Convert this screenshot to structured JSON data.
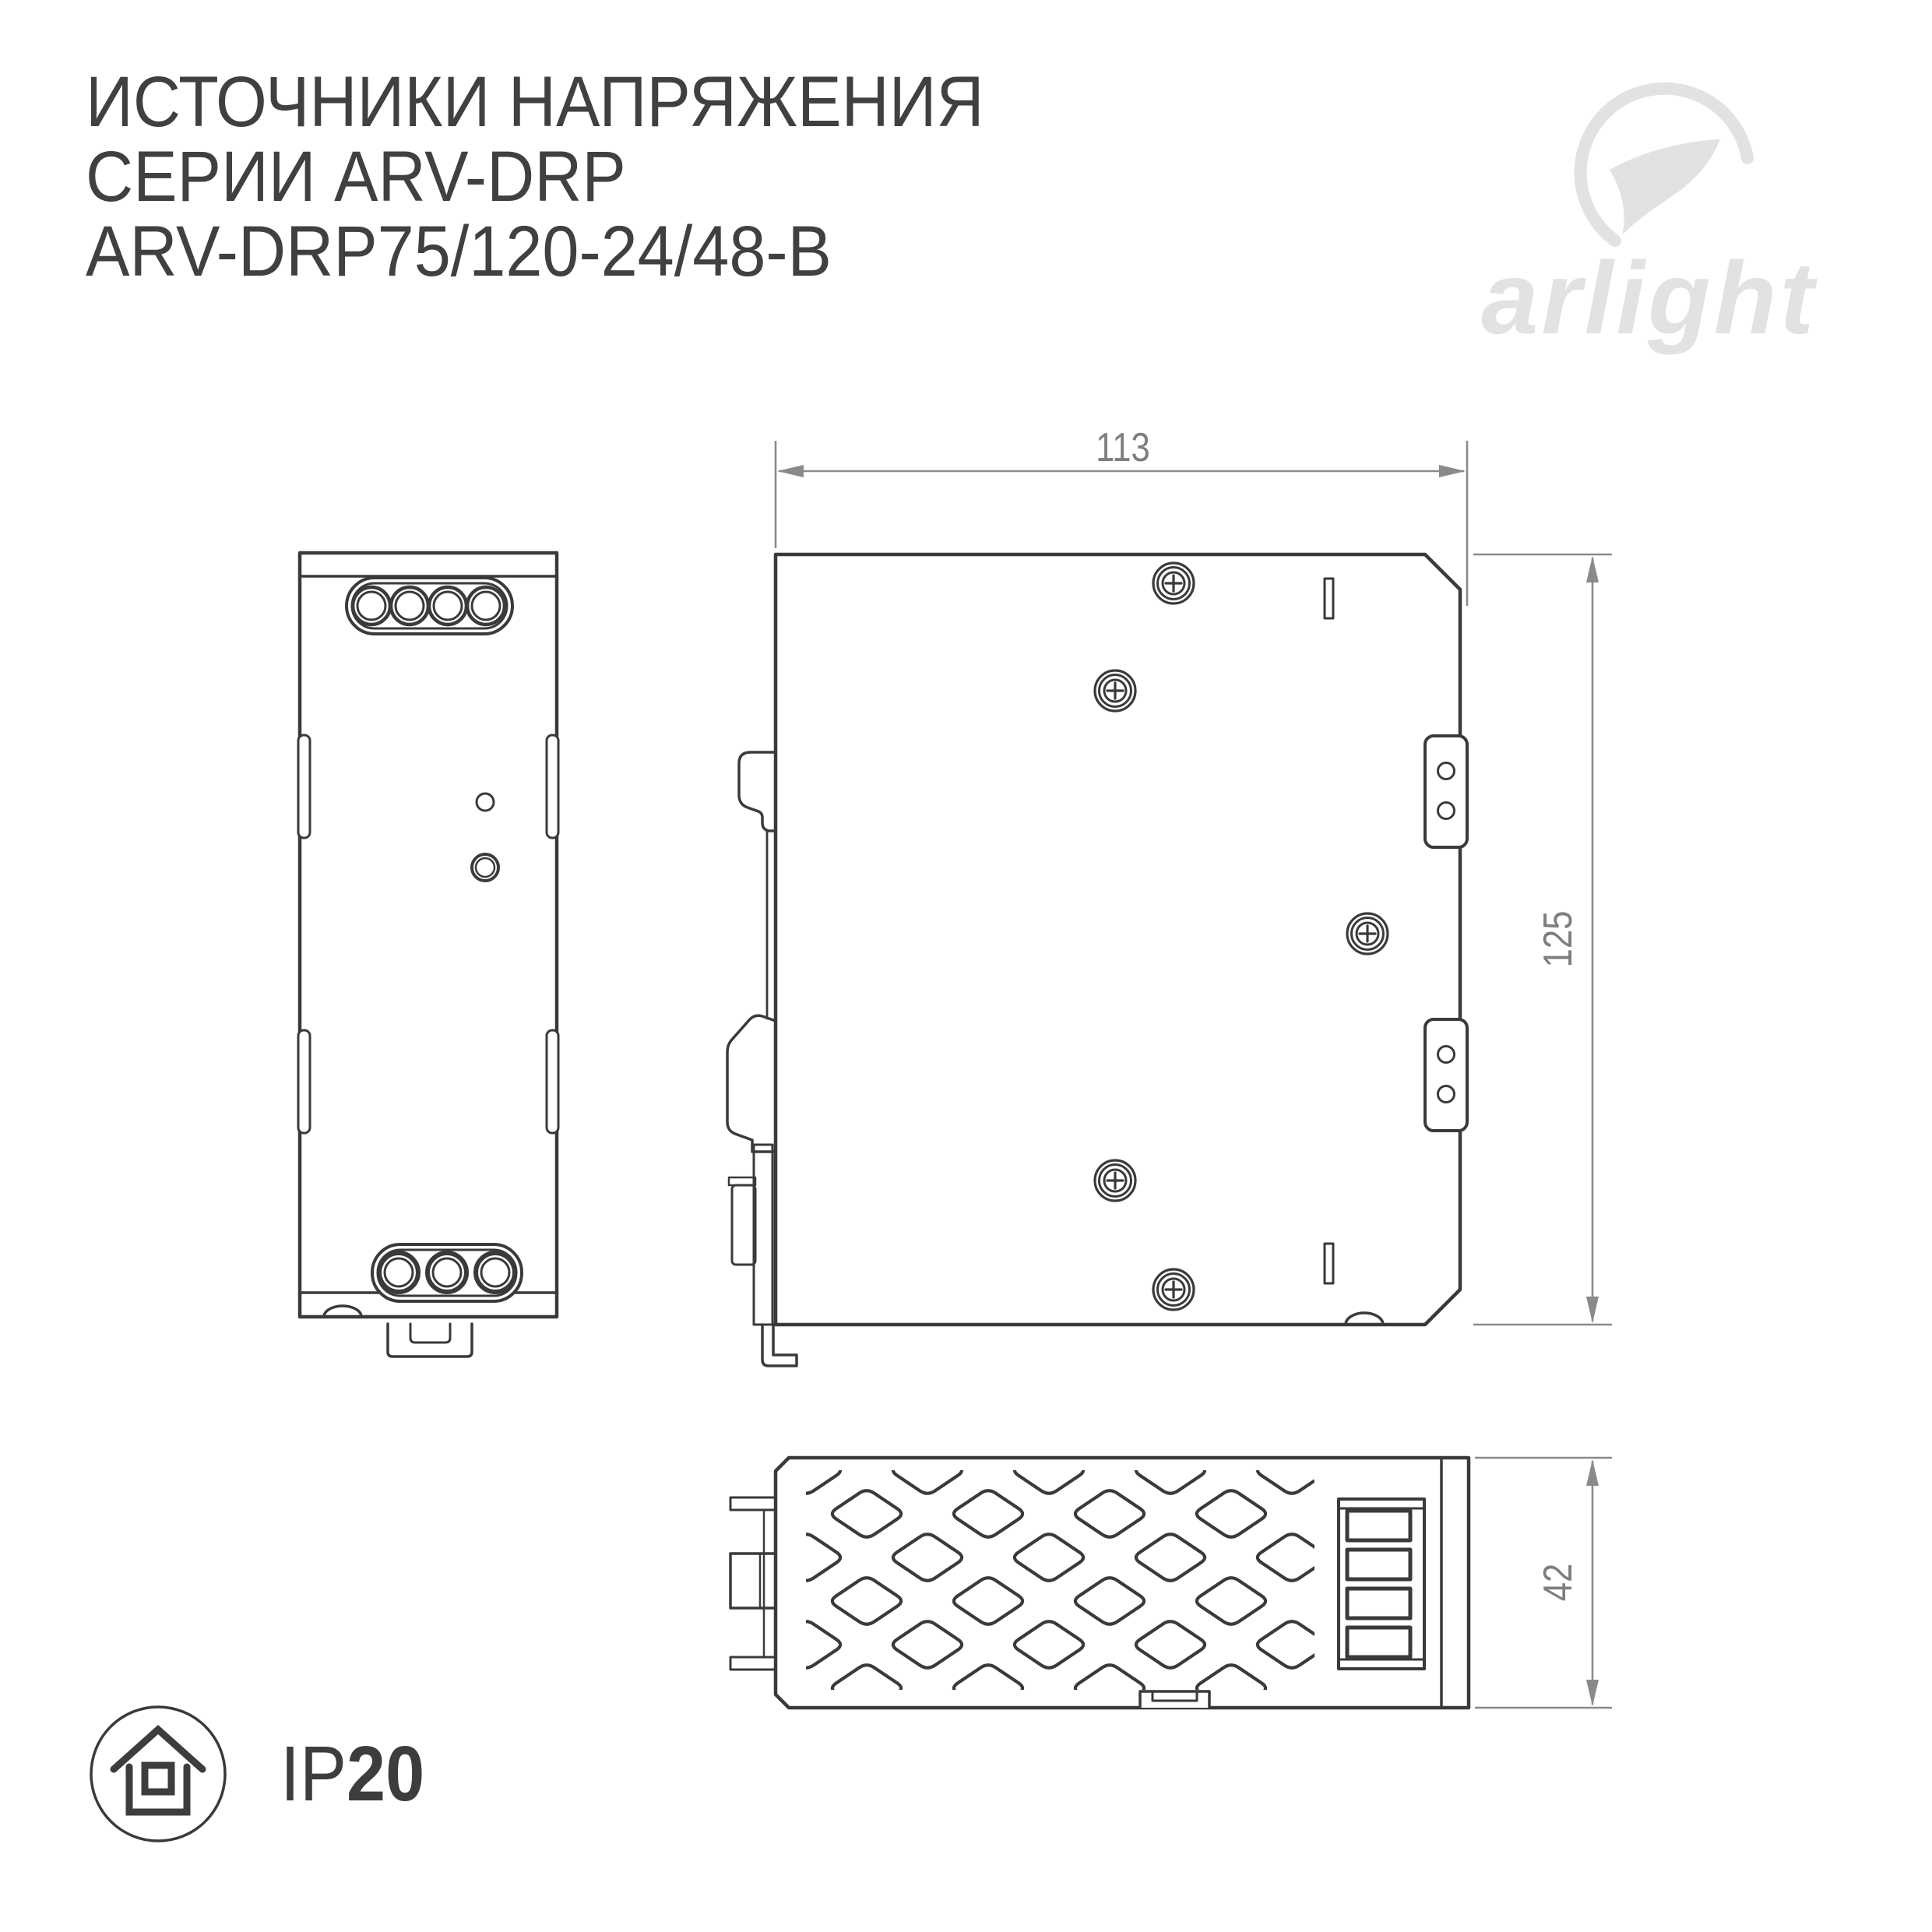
{
  "title": {
    "line1": "ИСТОЧНИКИ НАПРЯЖЕНИЯ",
    "line2": "СЕРИИ ARV-DRP",
    "line3": "ARV-DRP75/120-24/48-B"
  },
  "logo": {
    "wordmark": "arlight"
  },
  "dimensions": {
    "width_mm": "113",
    "height_mm": "125",
    "depth_mm": "42"
  },
  "ip_rating": {
    "prefix": "IP",
    "value": "20"
  },
  "colors": {
    "line": "#3a3a3a",
    "dimension_line": "#8a8a8a",
    "dimension_text": "#7e7e7e",
    "logo": "#e2e2e2",
    "title_text": "#404040",
    "background": "#ffffff"
  }
}
